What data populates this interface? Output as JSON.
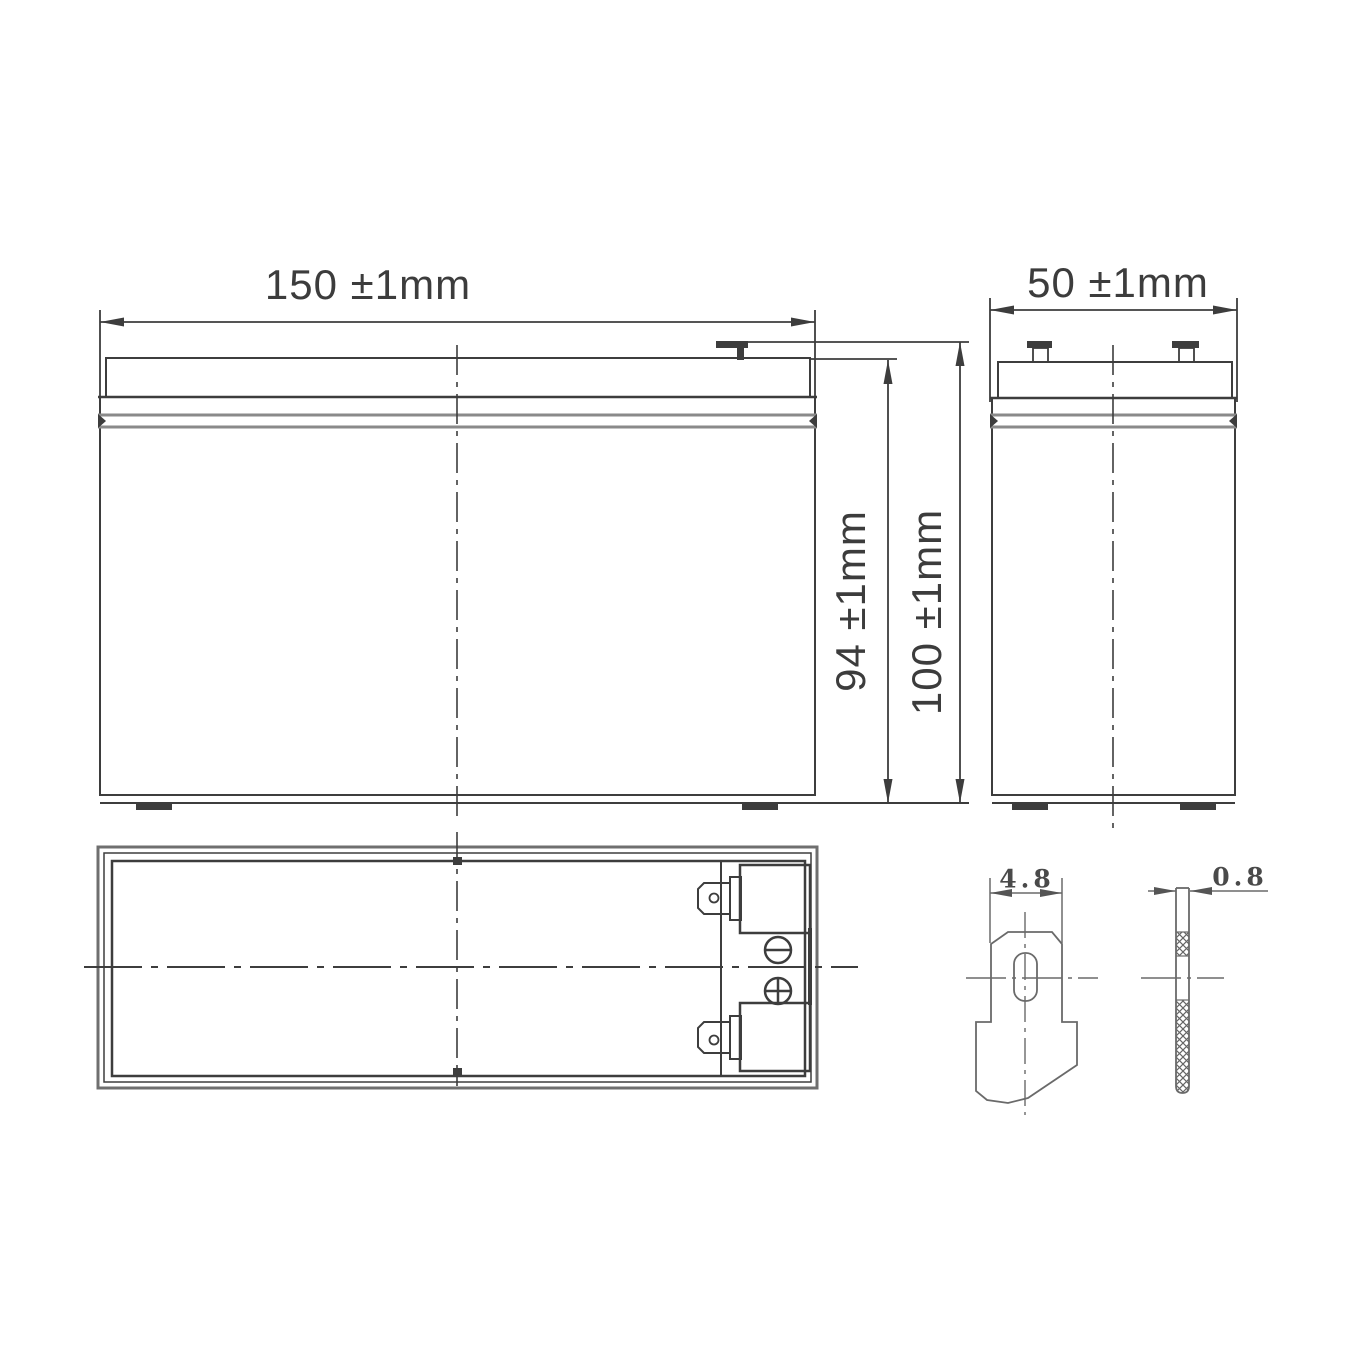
{
  "drawing": {
    "views": {
      "front": {
        "width_label": "150 ±1mm",
        "case_height_label": "94 ±1mm",
        "overall_height_label": "100 ±1mm"
      },
      "side": {
        "width_label": "50 ±1mm"
      },
      "terminal_detail": {
        "width_label": "4.8",
        "thickness_label": "0.8"
      }
    },
    "polarity": {
      "negative_symbol": "−",
      "positive_symbol": "+"
    },
    "colors": {
      "line": "#3d3d3d",
      "detail_line": "#6a6a6a",
      "seam_line": "#8a8a8a",
      "background": "#ffffff"
    }
  }
}
